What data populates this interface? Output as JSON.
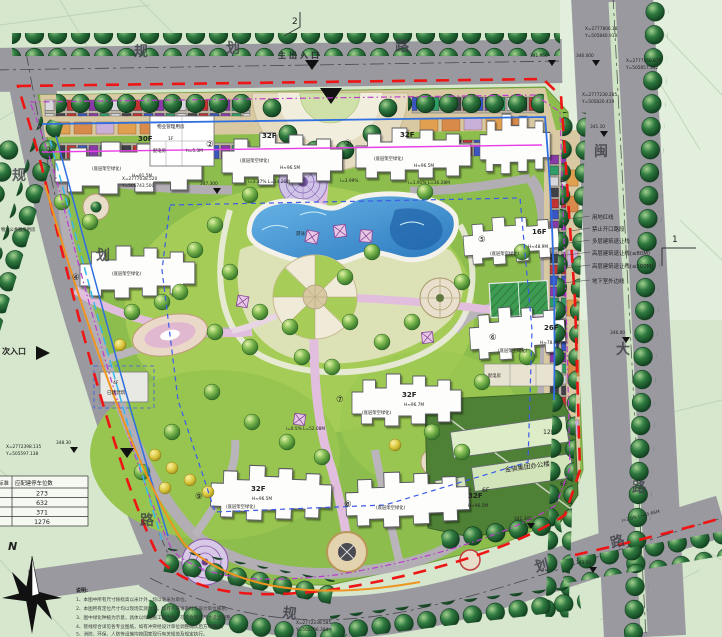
{
  "map": {
    "roads": {
      "top_name_chars": [
        "规",
        "划",
        "路"
      ],
      "left_name_chars": [
        "规",
        "划",
        "路"
      ],
      "right_name_chars": [
        "闽",
        "大",
        "路"
      ],
      "bottom_name_chars": [
        "规",
        "划",
        "路"
      ],
      "main_entrance": "主出入口",
      "secondary_entrance": "次入口"
    },
    "buildings": [
      {
        "num": "①",
        "floors": "30F",
        "note": "(底层架空绿化)",
        "height": "H≈91.5M"
      },
      {
        "num": "②",
        "floors": "32F",
        "note": "(底层架空绿化)",
        "height": "H≈96.5M"
      },
      {
        "num": "③",
        "floors": "32F",
        "note": "(底层架空绿化)",
        "height": "H≈96.5M"
      },
      {
        "num": "④",
        "floors": "",
        "note": "(底层架空绿化)",
        "height": ""
      },
      {
        "num": "⑤",
        "floors": "16F",
        "note": "(底层架空绿化)",
        "height": "H≈48.9M"
      },
      {
        "num": "⑥",
        "floors": "26F",
        "note": "(底层架空绿化)",
        "height": "H≈78.9M"
      },
      {
        "num": "⑦",
        "floors": "32F",
        "note": "(底层架空绿化)",
        "height": "H≈96.7M"
      },
      {
        "num": "⑧",
        "floors": "32F",
        "note": "(底层架空绿化)",
        "height": "H≈96.5M"
      },
      {
        "num": "⑨",
        "floors": "32F",
        "note": "(底层架空绿化)",
        "height": "H≈96.5M"
      }
    ],
    "facilities": {
      "management_house": {
        "name": "物业管理用房",
        "floors": "1F",
        "height": "h=5.3M"
      },
      "power_room": "配电房",
      "power_room2": "配电房",
      "existing_building": {
        "name": "已建建筑",
        "floors": "4F"
      },
      "office_compound": {
        "name": "金骐集团办公楼",
        "f12": "12F",
        "f6a": "6F",
        "f6b": "6F"
      },
      "pool_label": "游泳池",
      "service_room": "物业公共服务用房"
    },
    "boundary_labels": [
      "用地红线",
      "禁止开口路段",
      "多层建筑退让线",
      "高层建筑退让线(≤80M)",
      "高层建筑退让线(≤100M)",
      "地下室外边线"
    ],
    "parking_table": {
      "col_header_left": "标准",
      "col_header_right": "应配建停车位数",
      "values": [
        "273",
        "632",
        "371",
        "1276"
      ]
    },
    "north_label": "N",
    "section_marks": {
      "top": "2",
      "right": "1"
    },
    "elevations": [
      {
        "v": "341.950"
      },
      {
        "v": "346.000"
      },
      {
        "v": "341.10"
      },
      {
        "v": "346.00"
      },
      {
        "v": "347.300"
      },
      {
        "v": "343.50"
      },
      {
        "v": "341.345"
      },
      {
        "v": "348.30"
      }
    ],
    "coords": [
      {
        "x": "X=2777806.18",
        "y": "Y=505840.918"
      },
      {
        "x": "X=2777560.875",
        "y": "Y=505857.342"
      },
      {
        "x": "X=2777230.285",
        "y": "Y=505820.419"
      },
      {
        "x": "X=2777038.520",
        "y": "Y=505743.500"
      },
      {
        "x": "X=2772398.135",
        "y": "Y=505597.138"
      },
      {
        "x": "X=2772238.585",
        "y": "Y=505706.384"
      }
    ],
    "slopes": [
      {
        "v": "i=3.37% L=14.26M"
      },
      {
        "v": "i=3.99%"
      },
      {
        "v": "i=1.91% L=36.28M"
      },
      {
        "v": "i=0.5% L=52.08M"
      },
      {
        "v": "i=2.0% L=45.66M"
      }
    ],
    "notes": {
      "heading": "说明:",
      "items": [
        "1、本图中所有尺寸除标高以米计外，均以毫米为单位。",
        "2、本图所有定位尺寸均以现场实测为准，如有不符请及时与设计单位联系。",
        "3、图中绿化种植为示意，具体以绿化施工图为准，可结合现场尺寸适当调整。",
        "4、管线综合详见各专业图纸，如有冲突经设计单位调整确认后方可施工。",
        "5、消防、环保、人防等设施均按国家现行有关规范及规定执行。"
      ]
    }
  }
}
